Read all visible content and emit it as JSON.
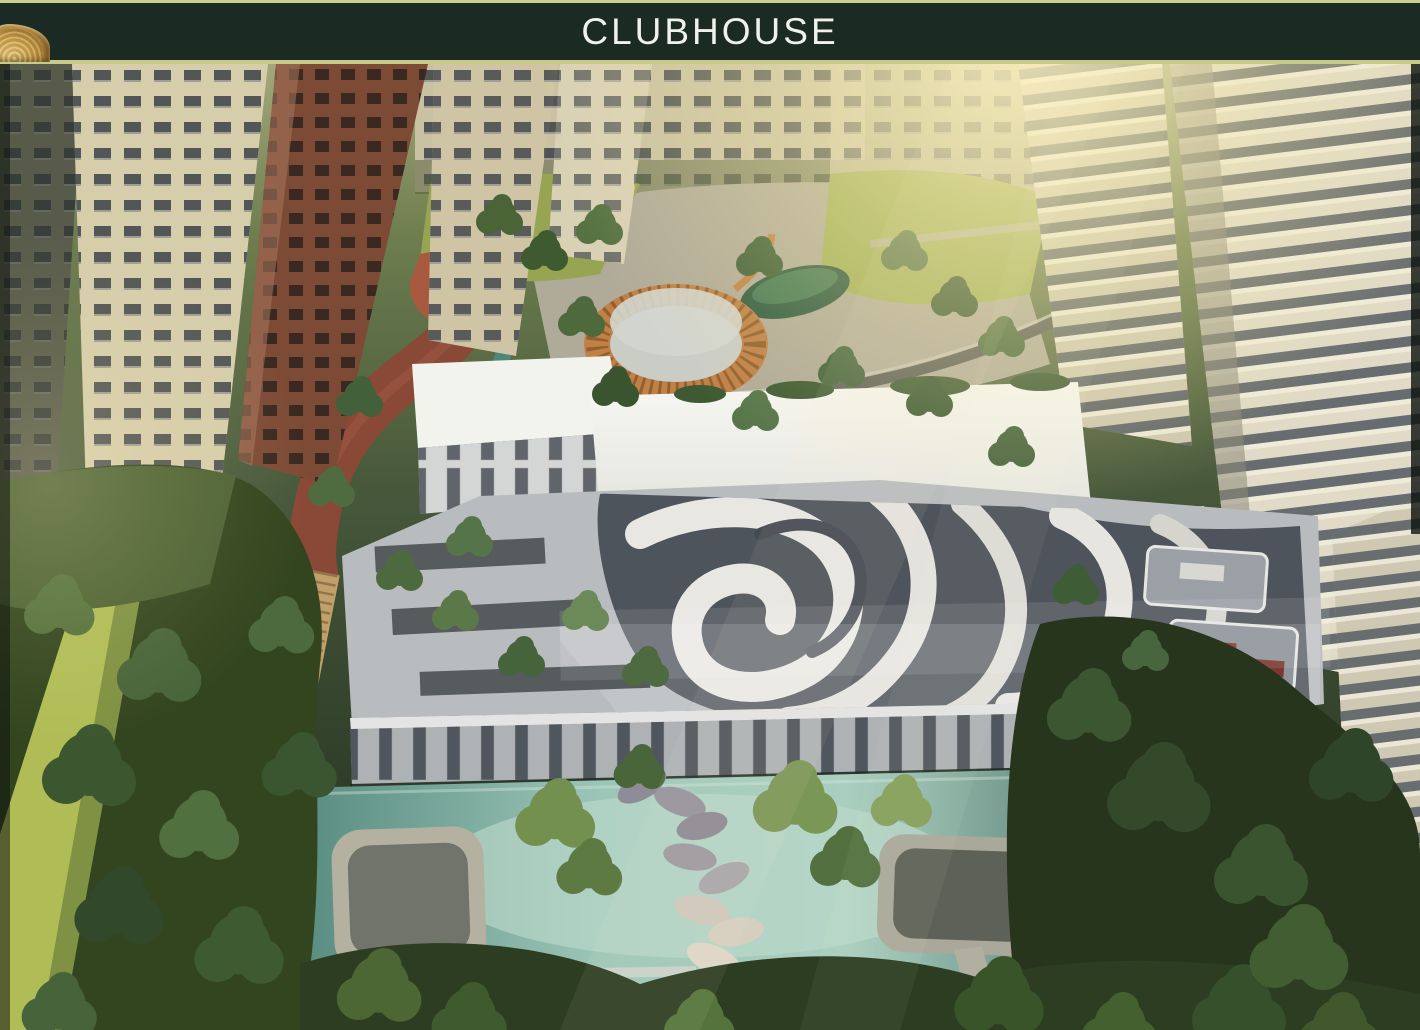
{
  "header": {
    "title": "CLUBHOUSE",
    "bar_color": "#1b2a22",
    "trim_line_color": "#ccd08e",
    "title_color": "#eef1ec",
    "emblem_color": "#cfa452"
  },
  "scene": {
    "description": "Aerial dusk rendering of a residential clubhouse: white flat-roofed clubhouse with swirl-patterned rooftop deck, circular timber-slat court, red jogging track with boardwalk, lawns, landscaped trees, long swimming pool with sunken lounges and petal stepping stones, framed by tall apartment towers.",
    "features": [
      "apartment-towers",
      "mid-rise-blocks",
      "clubhouse-roof-slab",
      "rooftop-swirl-deck",
      "circular-timber-screen",
      "green-pavilion",
      "jogging-track",
      "wooden-boardwalk",
      "lawn-strip",
      "louvered-facade",
      "swimming-pool",
      "sunken-lounge-left",
      "sunken-lounge-right",
      "petal-stepping-stones",
      "pool-steps",
      "dense-tree-canopy",
      "sun-glow"
    ],
    "colors": {
      "pool_water": "#9cc6b8",
      "track_red": "#8a4836",
      "timber": "#c8894e",
      "deck_dark": "#4e545c",
      "deck_light": "#e8e7e2",
      "tower_cream": "#d6cdab",
      "tower_maroon": "#7d4a36",
      "foliage_dark": "#2c3d22",
      "foliage_light": "#74904e",
      "lawn": "#b0bd56",
      "sun_glow": "#fff0b8"
    }
  }
}
